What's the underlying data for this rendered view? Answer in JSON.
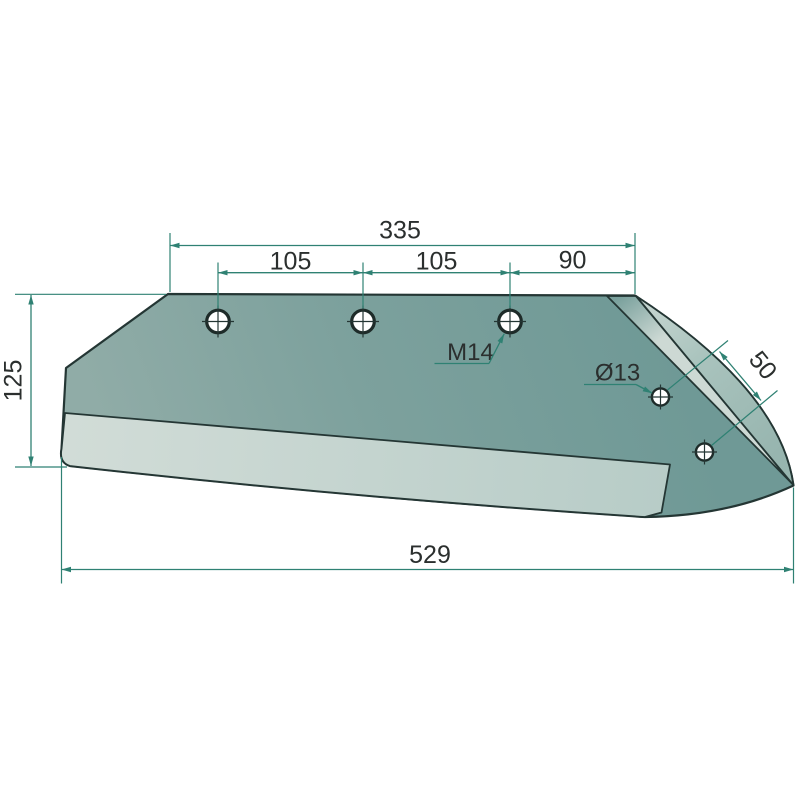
{
  "diagram": {
    "title": "plowshare wing blade technical drawing",
    "dims": {
      "top_total": "335",
      "pitch_left": "105",
      "pitch_mid": "105",
      "pitch_right": "90",
      "left_height": "125",
      "bottom_total": "529",
      "wing_edge_offset": "50"
    },
    "labels": {
      "thread": "M14",
      "hole_diameter": "Ø13"
    },
    "colors": {
      "dimension_accent": "#2f8173",
      "outline": "#243634",
      "face_dark": "#6f9996",
      "face_light": "#8faba6",
      "edge_strip_light": "#cfdad6",
      "edge_bevel_shaded": "#9ab8b2",
      "background": "#ffffff"
    }
  }
}
